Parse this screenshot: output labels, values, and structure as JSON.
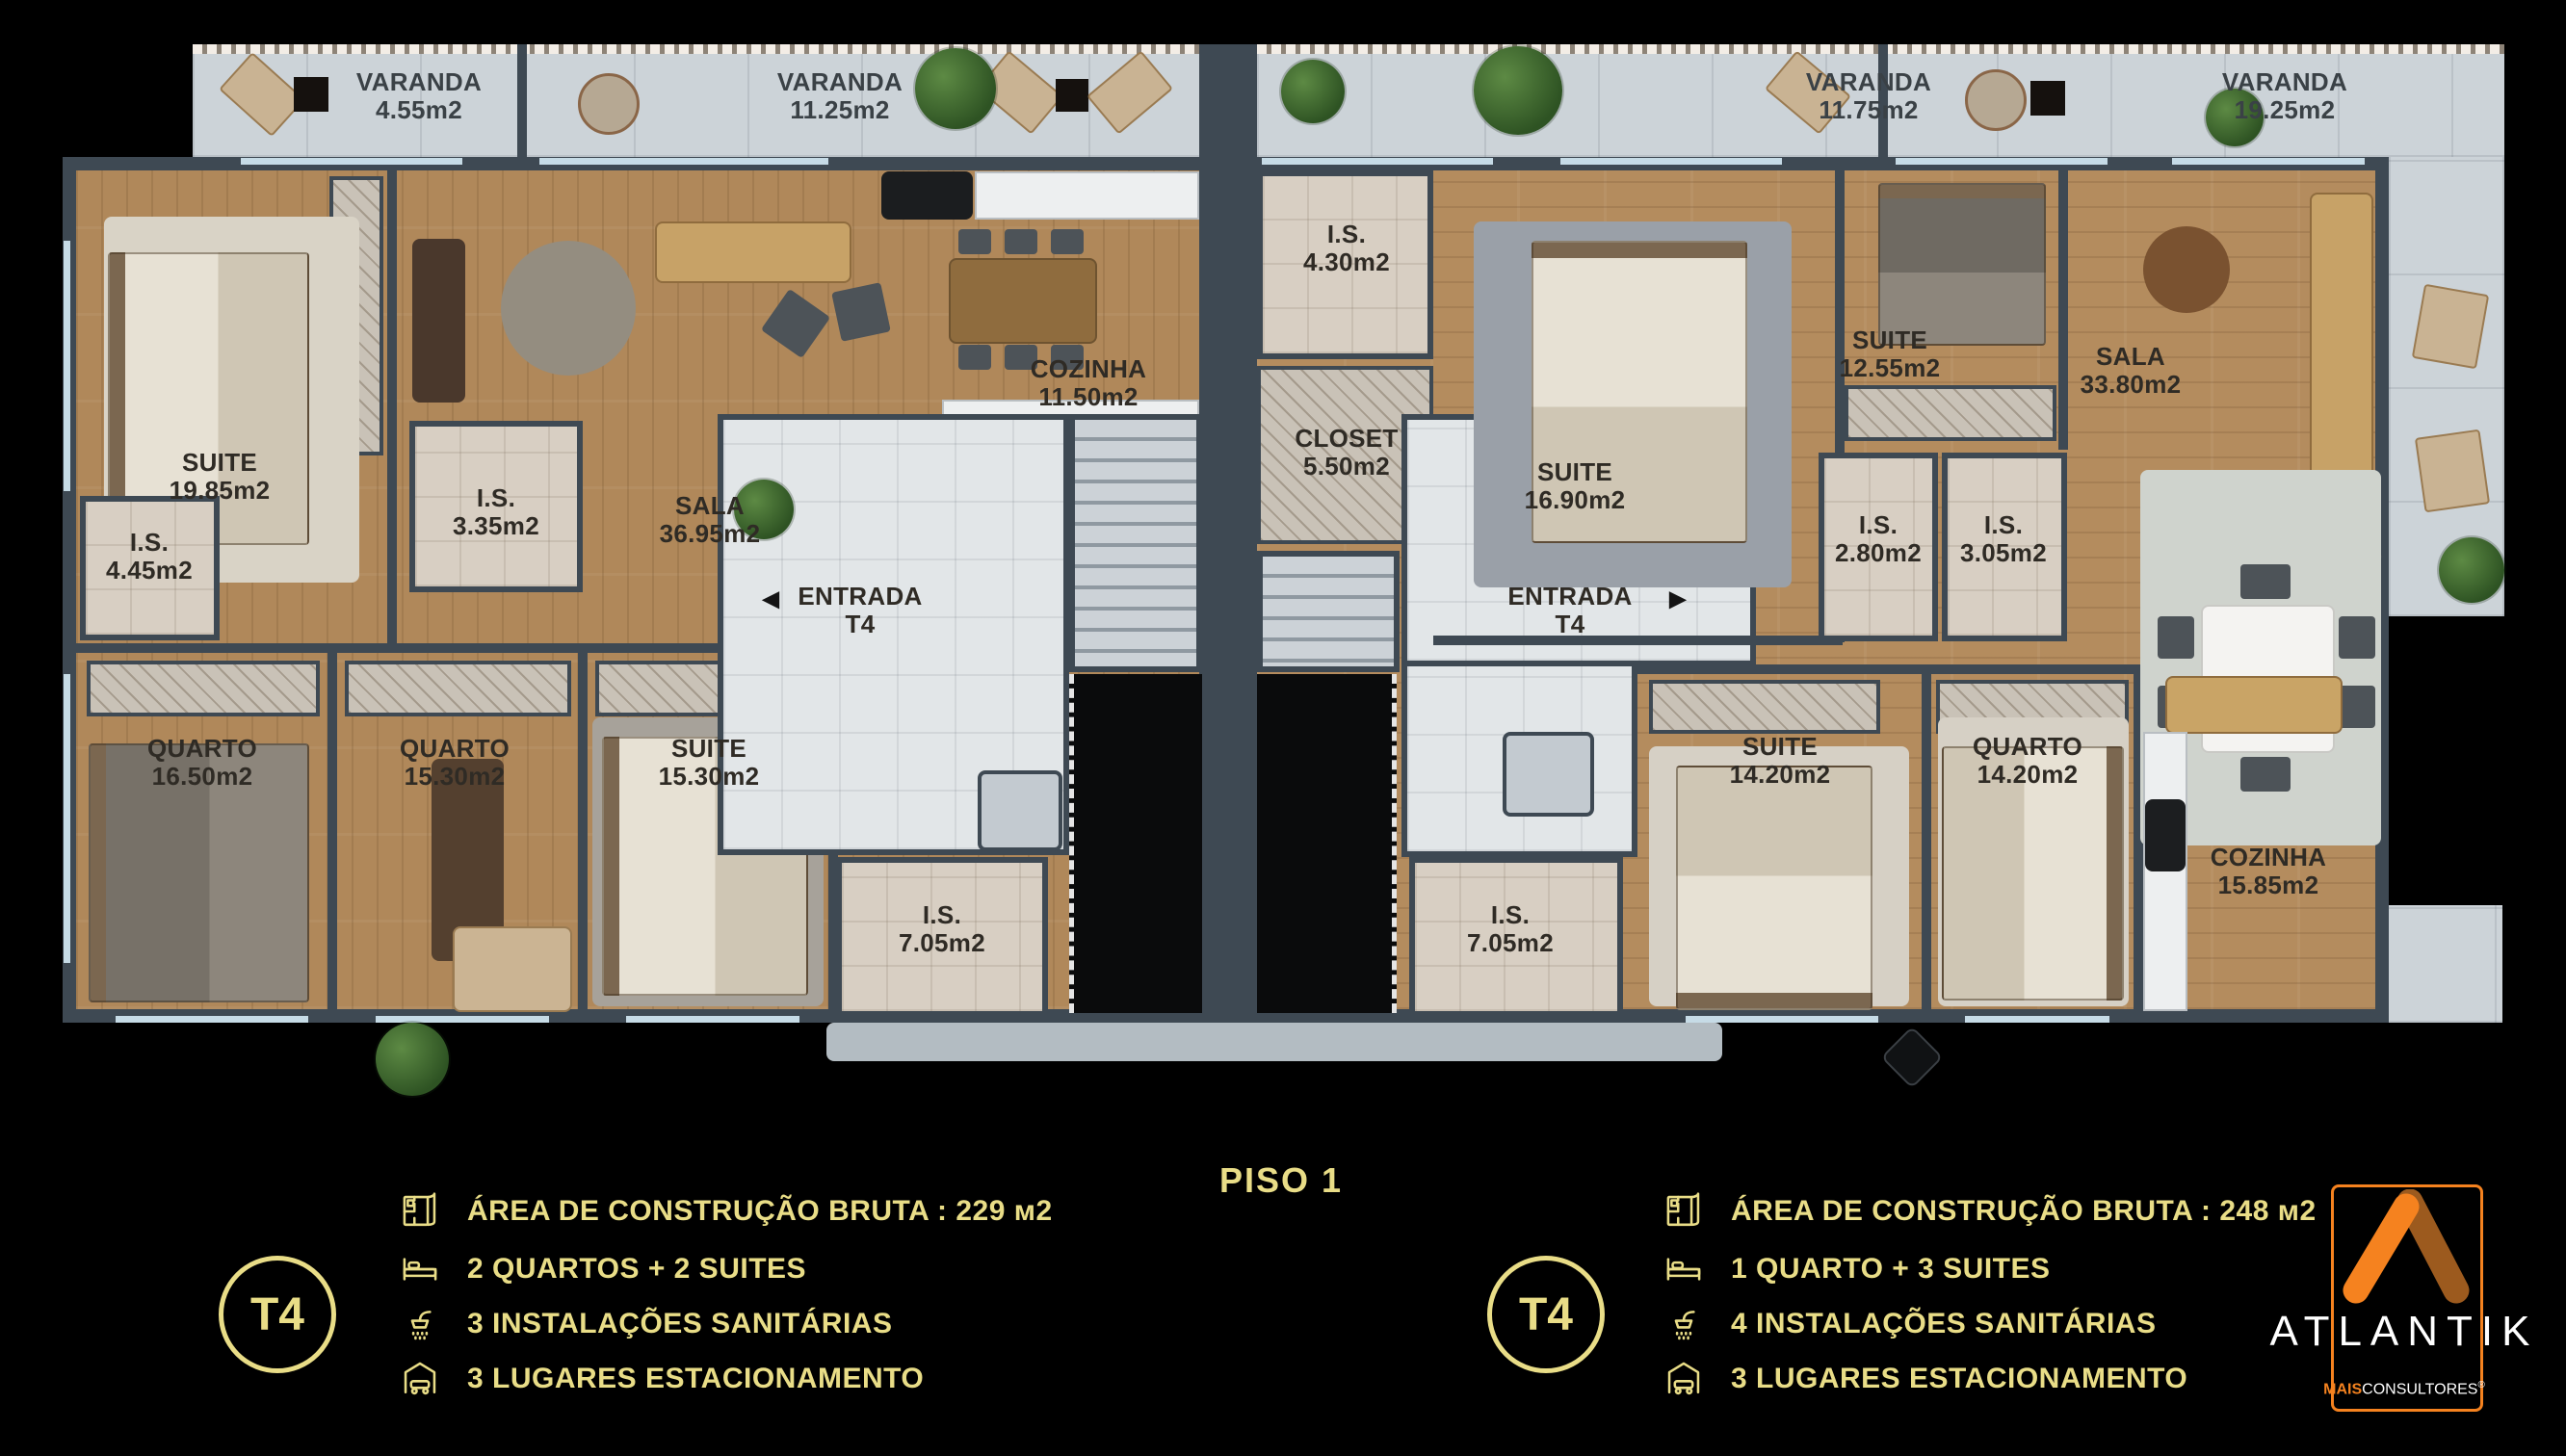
{
  "title": "PISO 1",
  "varandas": [
    {
      "name": "VARANDA",
      "area": "4.55m2"
    },
    {
      "name": "VARANDA",
      "area": "11.25m2"
    },
    {
      "name": "VARANDA",
      "area": "11.75m2"
    },
    {
      "name": "VARANDA",
      "area": "19.25m2"
    }
  ],
  "unit_left": {
    "entrance": {
      "label": "ENTRADA",
      "type": "T4",
      "arrow": "◀"
    },
    "rooms": [
      {
        "name": "SUITE",
        "area": "19.85m2"
      },
      {
        "name": "I.S.",
        "area": "4.45m2"
      },
      {
        "name": "I.S.",
        "area": "3.35m2"
      },
      {
        "name": "SALA",
        "area": "36.95m2"
      },
      {
        "name": "COZINHA",
        "area": "11.50m2"
      },
      {
        "name": "QUARTO",
        "area": "16.50m2"
      },
      {
        "name": "QUARTO",
        "area": "15.30m2"
      },
      {
        "name": "SUITE",
        "area": "15.30m2"
      },
      {
        "name": "I.S.",
        "area": "7.05m2"
      }
    ]
  },
  "unit_right": {
    "entrance": {
      "label": "ENTRADA",
      "type": "T4",
      "arrow": "▶"
    },
    "rooms": [
      {
        "name": "I.S.",
        "area": "4.30m2"
      },
      {
        "name": "CLOSET",
        "area": "5.50m2"
      },
      {
        "name": "SUITE",
        "area": "16.90m2"
      },
      {
        "name": "SUITE",
        "area": "12.55m2"
      },
      {
        "name": "I.S.",
        "area": "2.80m2"
      },
      {
        "name": "I.S.",
        "area": "3.05m2"
      },
      {
        "name": "SALA",
        "area": "33.80m2"
      },
      {
        "name": "SUITE",
        "area": "14.20m2"
      },
      {
        "name": "QUARTO",
        "area": "14.20m2"
      },
      {
        "name": "COZINHA",
        "area": "15.85m2"
      },
      {
        "name": "I.S.",
        "area": "7.05m2"
      }
    ]
  },
  "legend_left": {
    "badge": "T4",
    "items": [
      {
        "icon": "floorplan-icon",
        "text": "ÁREA DE CONSTRUÇÃO BRUTA :  229 м2"
      },
      {
        "icon": "bed-icon",
        "text": "2 QUARTOS + 2 SUITES"
      },
      {
        "icon": "shower-icon",
        "text": "3 INSTALAÇÕES SANITÁRIAS"
      },
      {
        "icon": "garage-icon",
        "text": "3 LUGARES ESTACIONAMENTO"
      }
    ]
  },
  "legend_right": {
    "badge": "T4",
    "items": [
      {
        "icon": "floorplan-icon",
        "text": "ÁREA DE CONSTRUÇÃO BRUTA :  248 м2"
      },
      {
        "icon": "bed-icon",
        "text": "1 QUARTO + 3 SUITES"
      },
      {
        "icon": "shower-icon",
        "text": "4 INSTALAÇÕES SANITÁRIAS"
      },
      {
        "icon": "garage-icon",
        "text": "3 LUGARES ESTACIONAMENTO"
      }
    ]
  },
  "brand": {
    "name": "ATLANTIK",
    "sub_bold": "MAIS",
    "sub_rest": "CONSULTORES",
    "sub_reg": "®"
  },
  "colors": {
    "legend_gold": "#E9DD87",
    "brand_orange": "#F5821F",
    "brand_orange_dark": "#9C5A1E",
    "wall": "#3E4953",
    "wood": "#B0885A",
    "balcony_tile": "#CCD3D8",
    "bathroom_tile": "#D8CFC3",
    "hall_tile": "#E2E6E8"
  }
}
